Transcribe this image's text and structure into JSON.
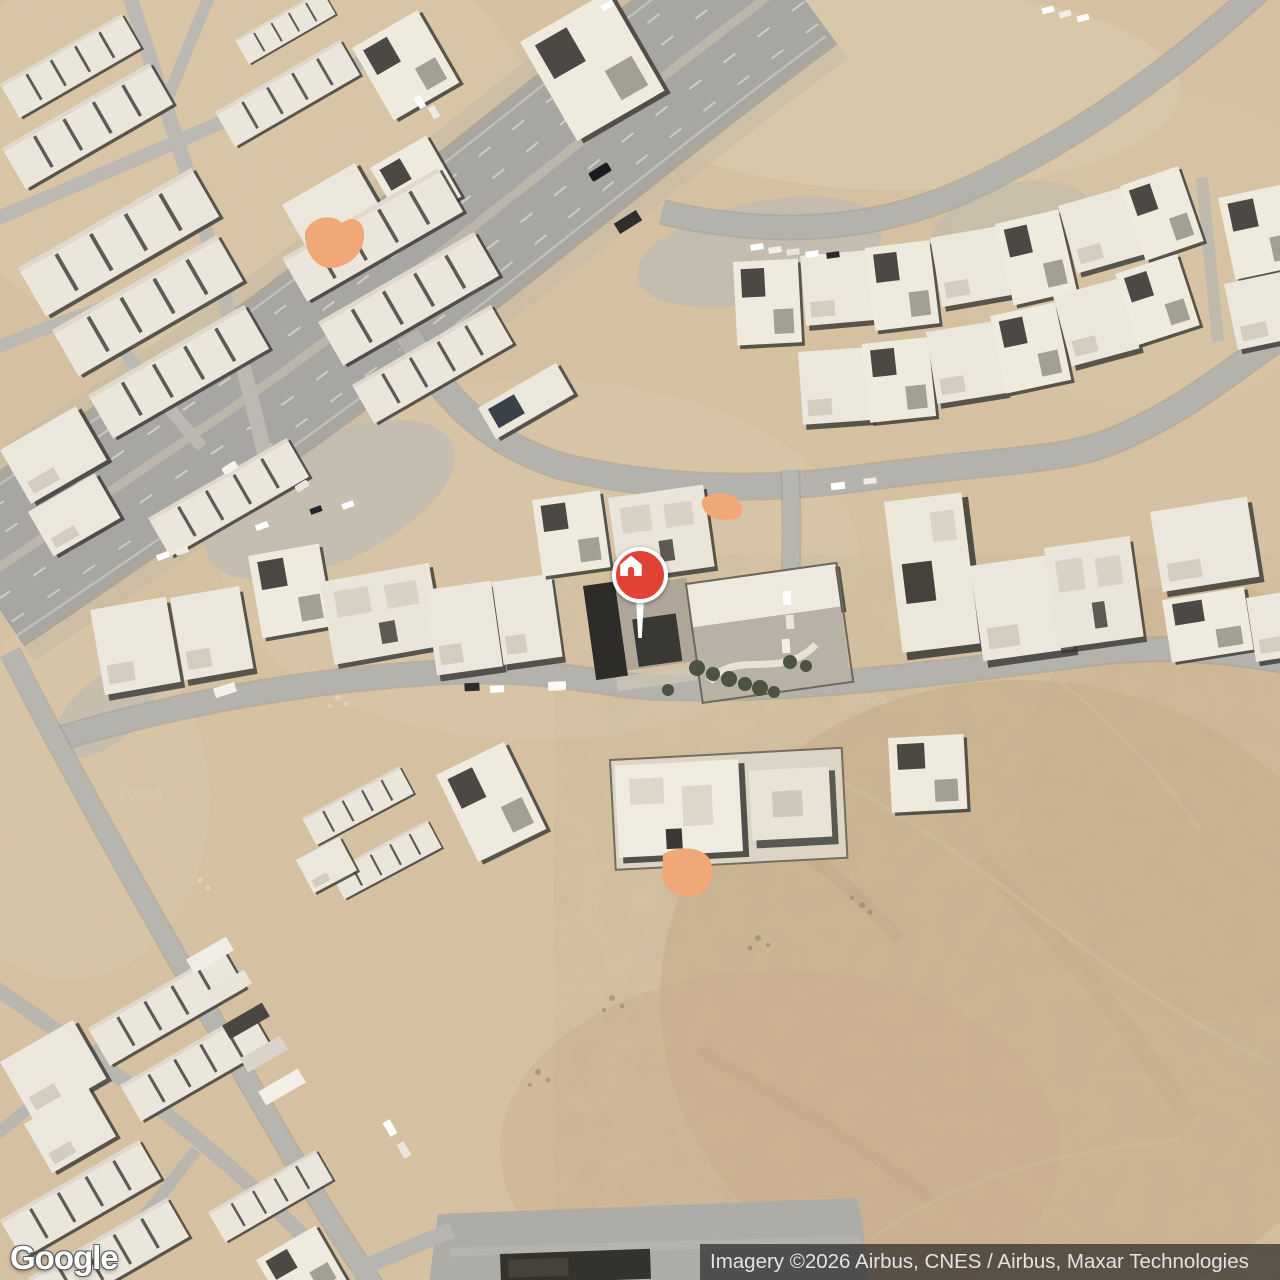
{
  "map": {
    "view_type": "satellite",
    "logo_text": "Google",
    "attribution_text": "Imagery ©2026 Airbus, CNES / Airbus, Maxar Technologies",
    "watermark_text": "©2026",
    "marker": {
      "kind": "home",
      "x": 640,
      "y": 575,
      "pin_color": "#E04336",
      "ring_color": "#FFFFFF",
      "icon": "home-icon"
    },
    "highlighted_parcels": {
      "color": "#F0A878",
      "count": 3,
      "centers": [
        {
          "x": 332,
          "y": 243
        },
        {
          "x": 721,
          "y": 507
        },
        {
          "x": 687,
          "y": 873
        }
      ]
    },
    "palette": {
      "sand": "#d7c3a3",
      "sand_light": "#e0cfb2",
      "desert_dark": "#c8ab87",
      "road": "#b4b2ad",
      "highway": "#a8a6a2",
      "building": "#ece7dc",
      "building_shadow": "#3a3834",
      "tree": "#4d5340",
      "marker_red": "#E04336",
      "highlight_orange": "#F0A878"
    }
  }
}
